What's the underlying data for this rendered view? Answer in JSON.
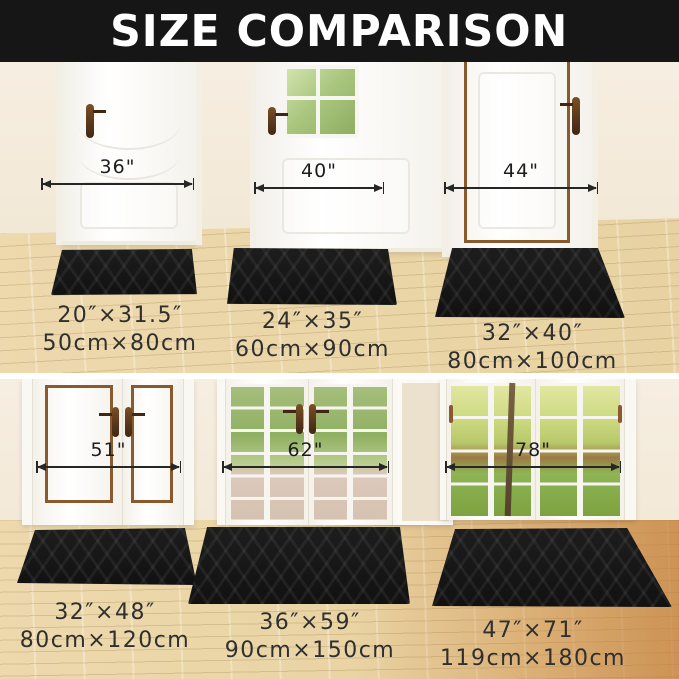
{
  "header": {
    "title": "SIZE COMPARISON"
  },
  "scenes": [
    {
      "door_type": "single panel door",
      "door_width": "36\"",
      "size_in": "20″×31.5″",
      "size_cm": "50cm×80cm"
    },
    {
      "door_type": "single door with window",
      "door_width": "40\"",
      "size_in": "24″×35″",
      "size_cm": "60cm×90cm"
    },
    {
      "door_type": "single door with brown trim",
      "door_width": "44\"",
      "size_in": "32″×40″",
      "size_cm": "80cm×100cm"
    },
    {
      "door_type": "double panel doors",
      "door_width": "51\"",
      "size_in": "32″×48″",
      "size_cm": "80cm×120cm"
    },
    {
      "door_type": "french glass doors",
      "door_width": "62\"",
      "size_in": "36″×59″",
      "size_cm": "90cm×150cm"
    },
    {
      "door_type": "patio glass doors",
      "door_width": "78\"",
      "size_in": "47″×71″",
      "size_cm": "119cm×180cm"
    }
  ],
  "colors": {
    "header_bg": "#161616",
    "header_fg": "#ffffff",
    "wall": "#f2e9d9",
    "floor_wood": "#e9d5a8",
    "floor_wood_warm": "#d39a5c",
    "mat": "#141414",
    "trim_brown": "#8a5a2e",
    "dimension_line": "#262626",
    "label_text": "#2f2f2f"
  }
}
